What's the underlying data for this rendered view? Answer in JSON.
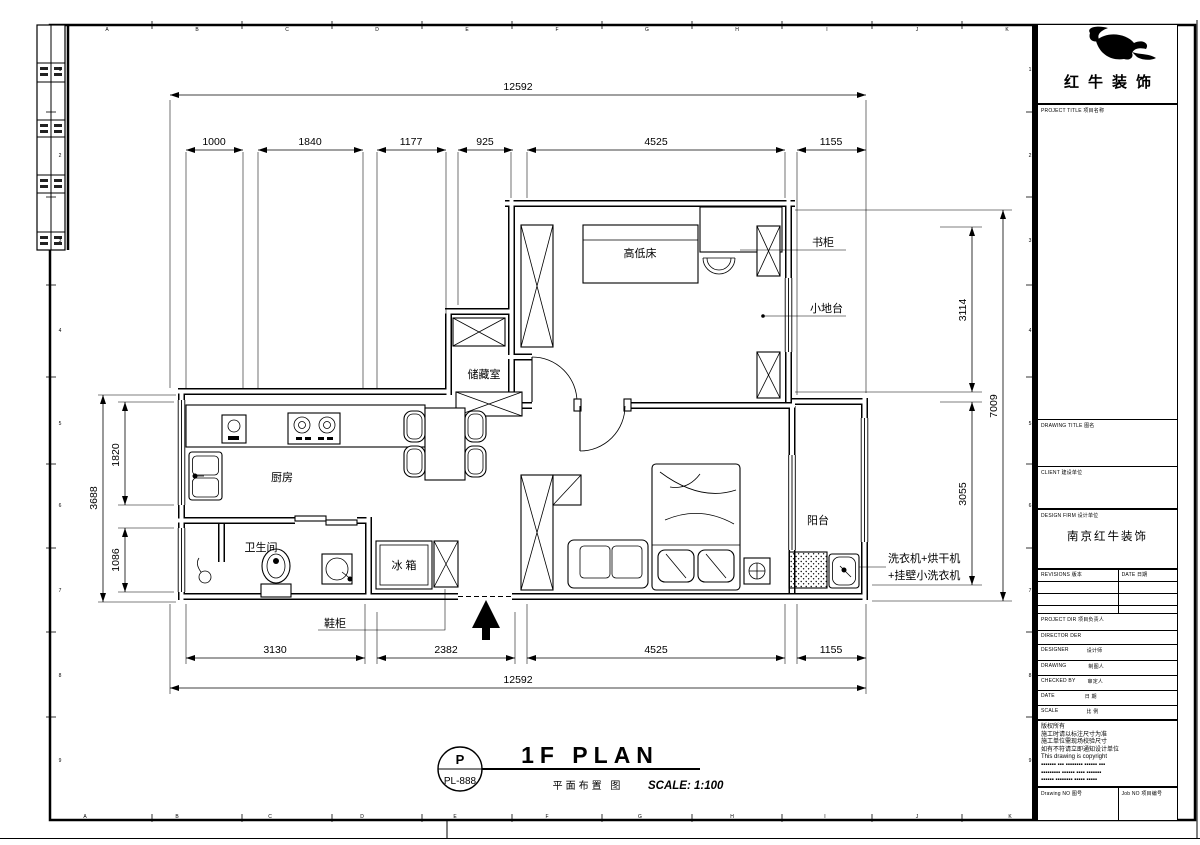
{
  "sheet": {
    "grid_letters": [
      "A",
      "B",
      "C",
      "D",
      "E",
      "F",
      "G",
      "H",
      "I",
      "J",
      "K"
    ],
    "grid_numbers": [
      "1",
      "2",
      "3",
      "4",
      "5",
      "6",
      "7",
      "8",
      "9"
    ]
  },
  "plan": {
    "room_labels": {
      "bunk_bed": "高低床",
      "storage": "储藏室",
      "kitchen": "厨房",
      "bathroom": "卫生间",
      "balcony": "阳台",
      "fridge": "冰 箱"
    },
    "callouts": {
      "bookcase": "书柜",
      "platform": "小地台",
      "shoe_cabinet": "鞋柜",
      "washer_line1": "洗衣机+烘干机",
      "washer_line2": "+挂壁小洗衣机"
    },
    "dims": {
      "top_total": "12592",
      "top_chain": [
        "1000",
        "1840",
        "1177",
        "925",
        "4525",
        "1155"
      ],
      "bottom_chain": [
        "3130",
        "2382",
        "4525",
        "1155"
      ],
      "bottom_total": "12592",
      "left_total": "3688",
      "left_chain": [
        "1820",
        "1086"
      ],
      "right_chain": [
        "3114",
        "3055"
      ],
      "right_total": "7009"
    }
  },
  "title_bar": {
    "badge_letter": "P",
    "badge_code": "PL-888",
    "title": "1F PLAN",
    "subtitle_cn": "平面布置 图",
    "scale": "SCALE: 1:100"
  },
  "title_block": {
    "logo_text": "红牛装饰",
    "project_title_label": "PROJECT TITLE  项目名称",
    "drawing_title_label": "DRAWING TITLE  图名",
    "client_label": "CLIENT  建设单位",
    "design_firm_label": "DESIGN FIRM  设计单位",
    "design_firm_value": "南京红牛装饰",
    "revisions_label": "REVISIONS  版本",
    "rev_date_label": "DATE  日期",
    "project_dir_label": "PROJECT DIR  项目负责人",
    "director_label": "DIRECTOR DER",
    "designer_label": "DESIGNER",
    "designer_cn": "设计师",
    "drawing_label": "DRAWING",
    "drawing_cn": "制图人",
    "checked_label": "CHECKED BY",
    "checked_cn": "审定人",
    "date_label": "DATE",
    "date_cn": "日 期",
    "scale_label": "SCALE",
    "scale_cn": "比 例",
    "notes": "版权所有\n施工时请以标注尺寸为准\n施工单位需现场校验尺寸\n如有不符请立即通知设计单位\nThis drawing is copyright\n▪▪▪▪▪▪▪ ▪▪▪ ▪▪▪▪▪▪▪▪ ▪▪▪▪▪▪ ▪▪▪\n▪▪▪▪▪▪▪▪▪ ▪▪▪▪▪▪ ▪▪▪▪ ▪▪▪▪▪▪▪\n▪▪▪▪▪▪ ▪▪▪▪▪▪▪▪ ▪▪▪▪▪ ▪▪▪▪▪",
    "drawing_no_label": "Drawing NO  图号",
    "job_no_label": "Job NO  项目编号"
  }
}
